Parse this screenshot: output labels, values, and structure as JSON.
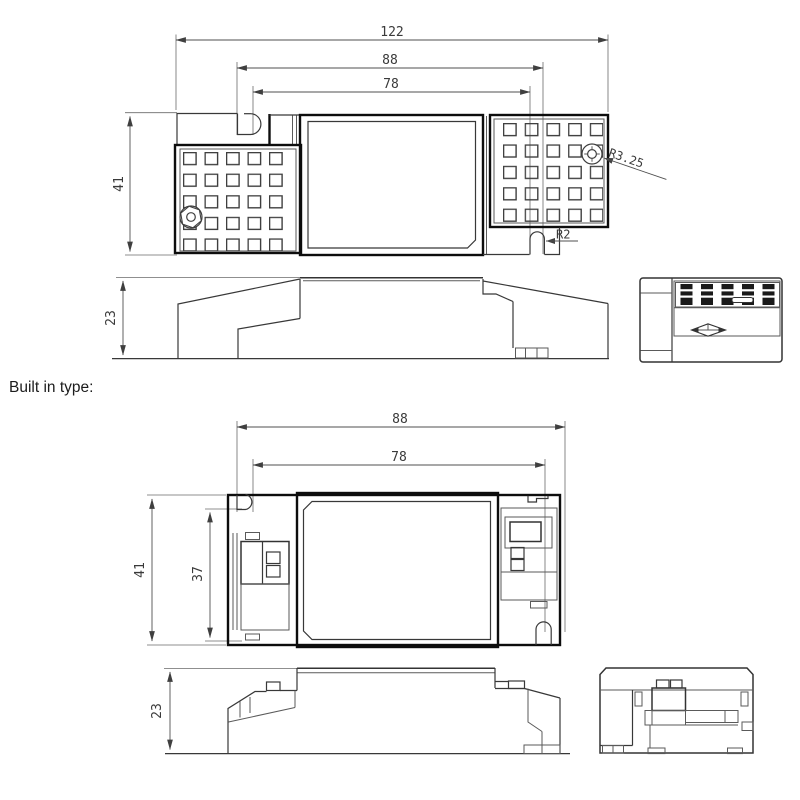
{
  "page": {
    "background": "#ffffff",
    "section_label": "Built in type:"
  },
  "colors": {
    "line": "#4f4f4f",
    "bold": "#0d0d0d",
    "dim_text": "#3a3a3a"
  },
  "standard_type": {
    "plan": {
      "width_overall": "122",
      "width_mount": "88",
      "width_inner": "78",
      "height": "41",
      "screw_radius": "R3.25",
      "notch_radius": "R2"
    },
    "side": {
      "height": "23"
    }
  },
  "built_in_type": {
    "plan": {
      "width_mount": "88",
      "width_inner": "78",
      "height": "41",
      "height_inner": "37"
    },
    "side": {
      "height": "23"
    }
  }
}
